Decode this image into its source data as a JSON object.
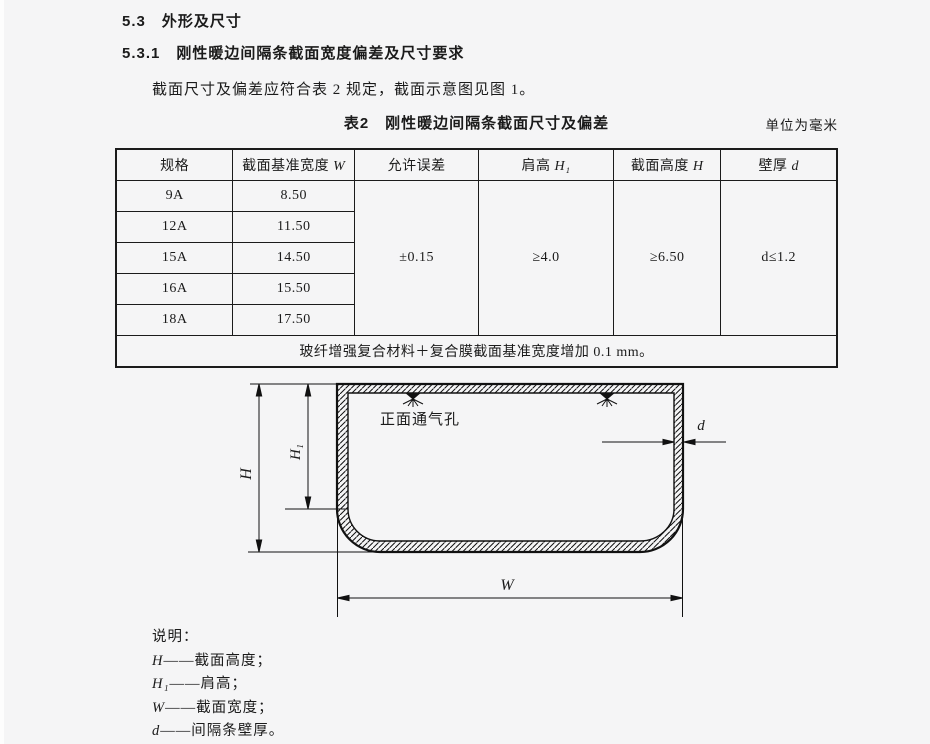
{
  "page": {
    "section_heading": "5.3　外形及尺寸",
    "subsection_heading": "5.3.1　刚性暖边间隔条截面宽度偏差及尺寸要求",
    "paragraph": "截面尺寸及偏差应符合表 2 规定，截面示意图见图 1。"
  },
  "table": {
    "title": "表2　刚性暖边间隔条截面尺寸及偏差",
    "unit_note": "单位为毫米",
    "headers": [
      {
        "label": "规格",
        "var": ""
      },
      {
        "label": "截面基准宽度 ",
        "var": "W"
      },
      {
        "label": "允许误差",
        "var": ""
      },
      {
        "label": "肩高 ",
        "var": "H₁"
      },
      {
        "label": "截面高度 ",
        "var": "H"
      },
      {
        "label": "壁厚 ",
        "var": "d"
      }
    ],
    "rows": [
      {
        "spec": "9A",
        "base_width": "8.50"
      },
      {
        "spec": "12A",
        "base_width": "11.50"
      },
      {
        "spec": "15A",
        "base_width": "14.50"
      },
      {
        "spec": "16A",
        "base_width": "15.50"
      },
      {
        "spec": "18A",
        "base_width": "17.50"
      }
    ],
    "merged": {
      "tolerance": "±0.15",
      "shoulder_height": "≥4.0",
      "section_height": "≥6.50",
      "wall_thickness": "d≤1.2"
    },
    "footnote": "玻纤增强复合材料＋复合膜截面基准宽度增加 0.1 mm。"
  },
  "figure": {
    "vent_label": "正面通气孔",
    "dim_h": "H",
    "dim_h1": "H₁",
    "dim_w": "W",
    "dim_d": "d"
  },
  "legend": {
    "title": "说明：",
    "items": [
      {
        "var": "H",
        "desc": "——截面高度；"
      },
      {
        "var": "H₁",
        "desc": "——肩高；"
      },
      {
        "var": "W",
        "desc": "——截面宽度；"
      },
      {
        "var": "d",
        "desc": "——间隔条壁厚。"
      }
    ]
  },
  "colors": {
    "background": "#f5f5f6",
    "ink": "#1b1b1b"
  }
}
